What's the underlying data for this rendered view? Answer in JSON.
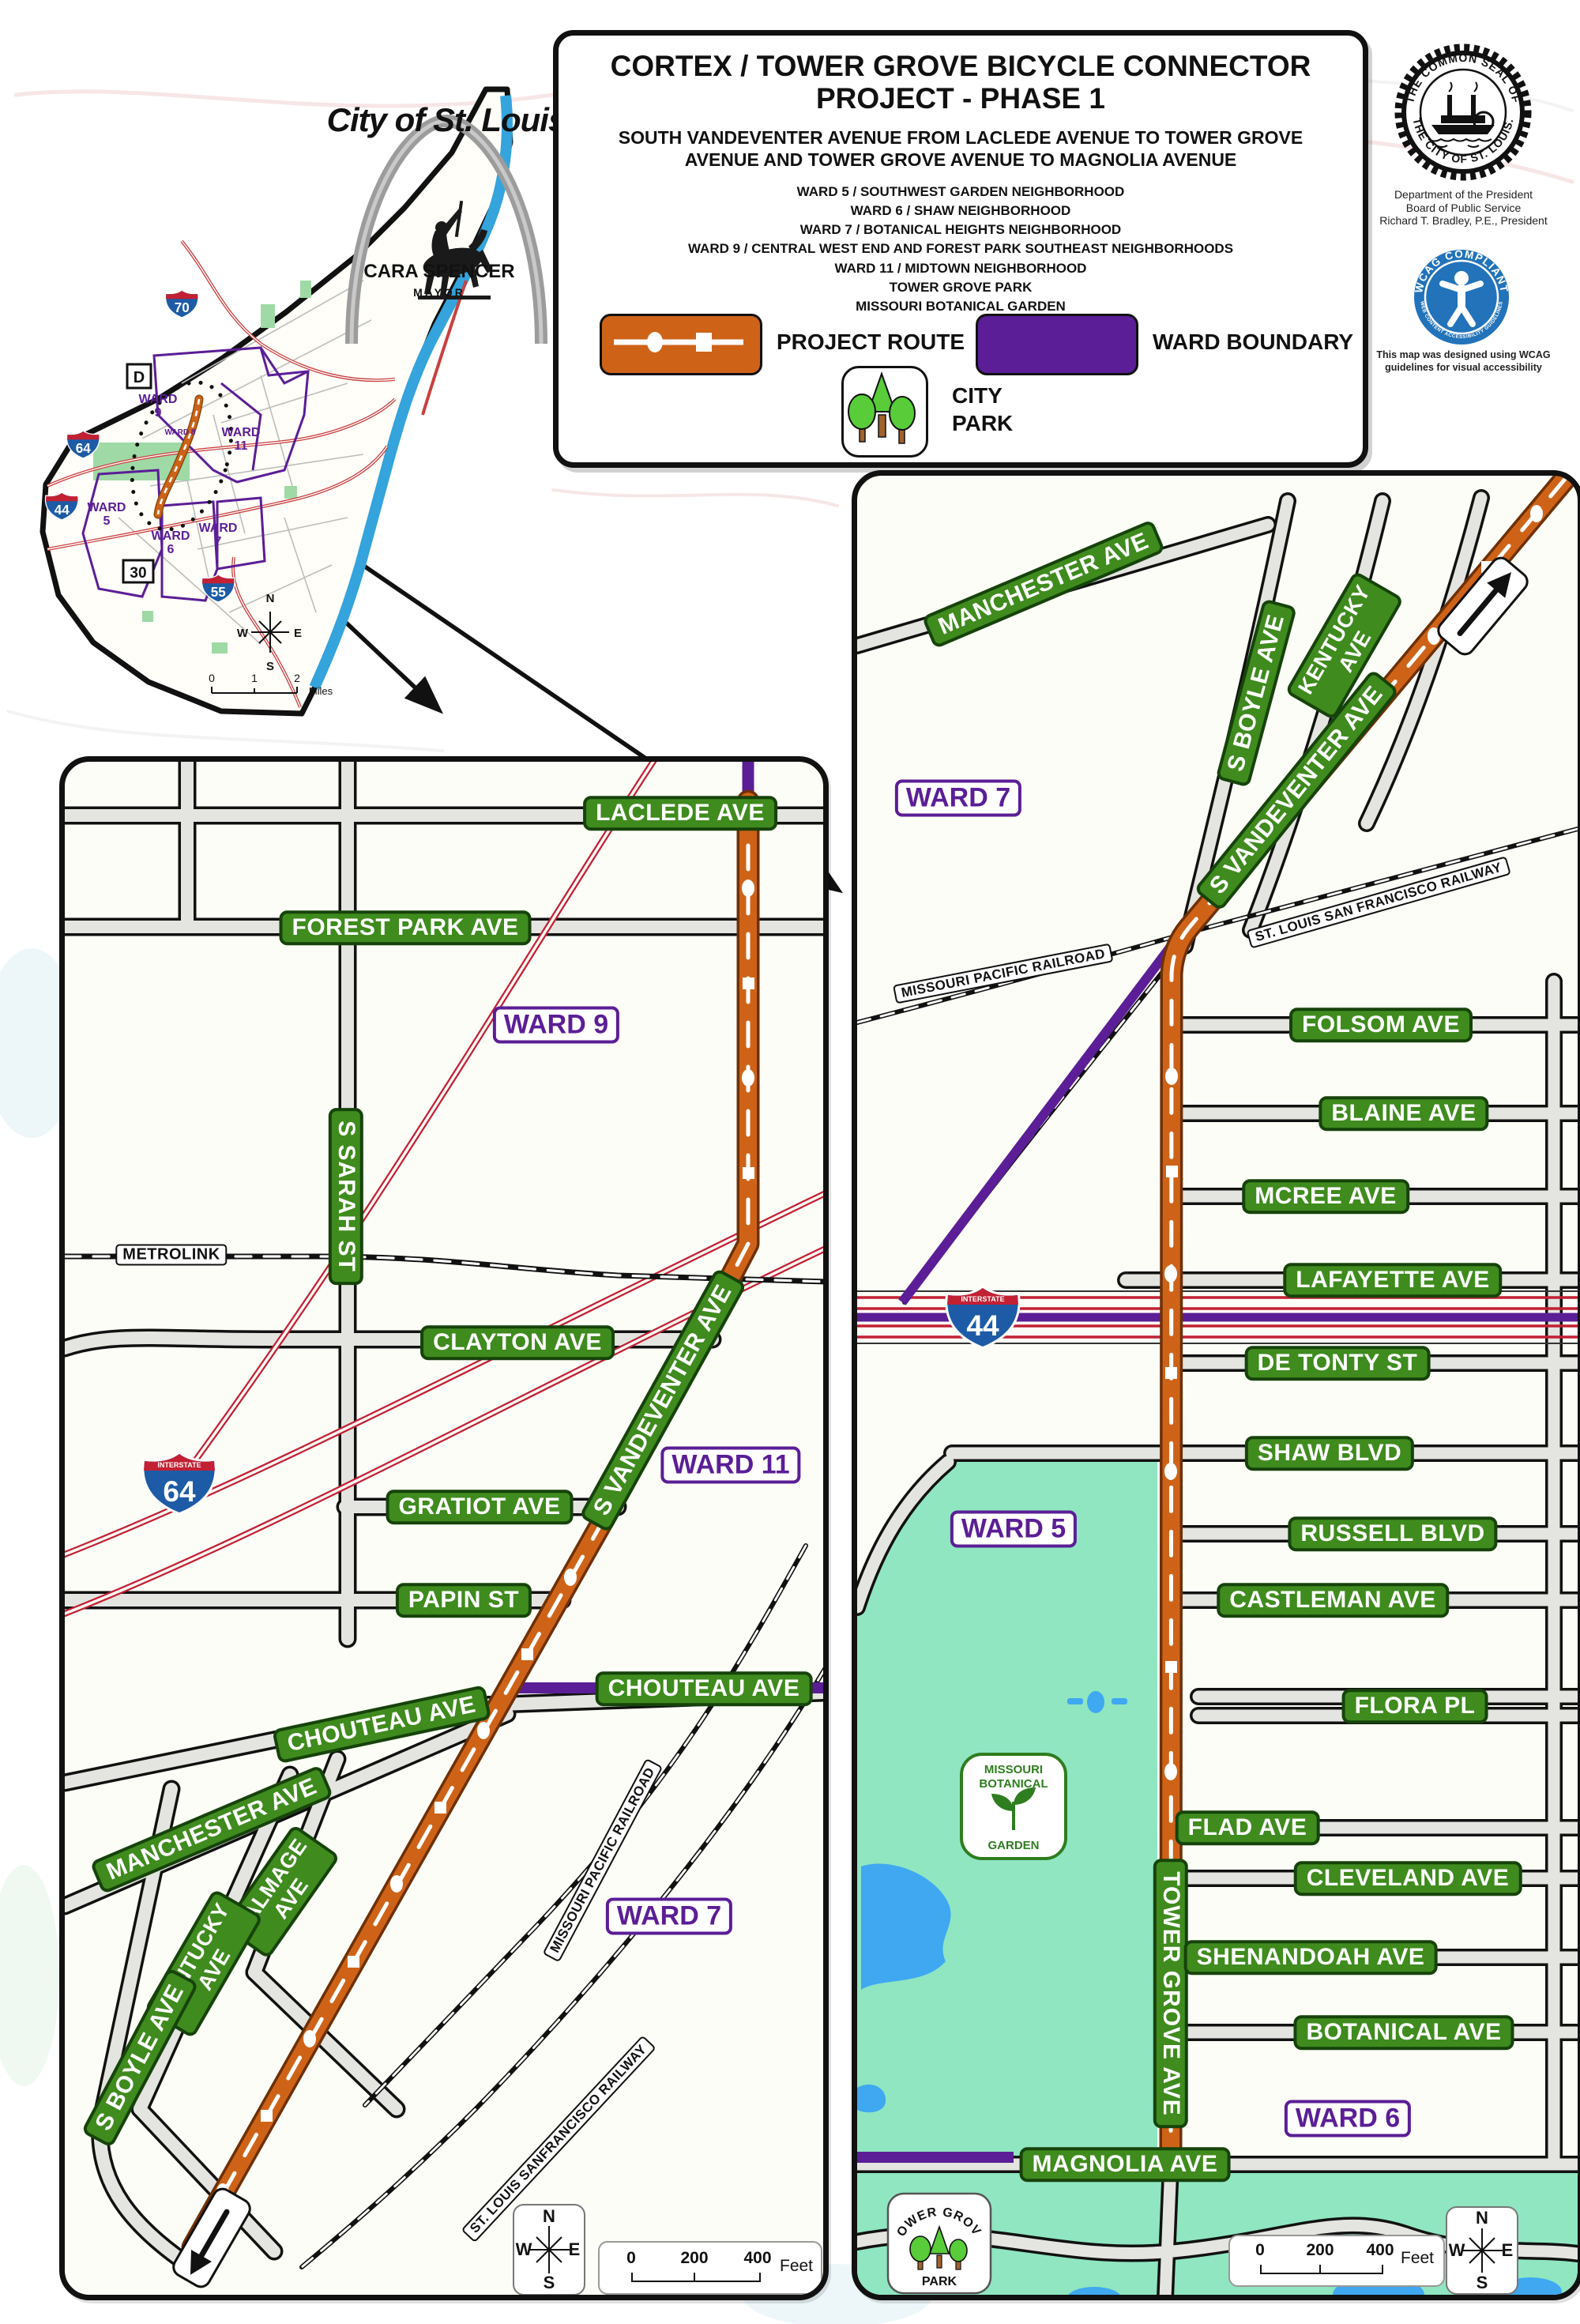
{
  "colors": {
    "project_route": "#CE6318",
    "ward_boundary": "#5B1E96",
    "city_park": "#8FE6C1",
    "street_sign_green": "#3F8B1E",
    "interstate_red": "#C22033",
    "interstate_blue": "#1D5BA6",
    "wcag_blue": "#2273BA",
    "river_blue": "#35A3DC"
  },
  "title_block": {
    "title": "CORTEX / TOWER GROVE BICYCLE CONNECTOR PROJECT - PHASE 1",
    "subtitle": "SOUTH VANDEVENTER AVENUE FROM LACLEDE AVENUE TO TOWER GROVE AVENUE AND TOWER GROVE AVENUE TO MAGNOLIA AVENUE",
    "areas": [
      "WARD 5 / SOUTHWEST GARDEN NEIGHBORHOOD",
      "WARD 6 / SHAW NEIGHBORHOOD",
      "WARD 7 / BOTANICAL HEIGHTS NEIGHBORHOOD",
      "WARD 9 / CENTRAL WEST END AND FOREST PARK SOUTHEAST NEIGHBORHOODS",
      "WARD 11 / MIDTOWN NEIGHBORHOOD",
      "TOWER GROVE PARK",
      "MISSOURI BOTANICAL GARDEN"
    ],
    "legend": {
      "route": "PROJECT ROUTE",
      "ward": "WARD BOUNDARY",
      "park": "CITY PARK"
    }
  },
  "branding": {
    "logo_title": "City of St. Louis",
    "mayor_name": "CARA SPENCER",
    "mayor_title": "MAYOR",
    "seal": {
      "arc_top": "THE COMMON SEAL OF",
      "arc_bottom": "THE CITY OF ST. LOUIS.",
      "caption": [
        "Department of the President",
        "Board of Public Service",
        "Richard T. Bradley, P.E., President"
      ]
    },
    "wcag": {
      "arc_top": "WCAG COMPLIANT",
      "arc_bottom": "WEB CONTENT ACCESSIBILITY GUIDELINES",
      "caption": [
        "This map was designed using WCAG",
        "guidelines for visual accessibility"
      ]
    }
  },
  "compass": {
    "n": "N",
    "e": "E",
    "s": "S",
    "w": "W"
  },
  "scale_detail": {
    "t0": "0",
    "t1": "200",
    "t2": "400",
    "unit": "Feet"
  },
  "scale_inset": {
    "t0": "0",
    "t1": "1",
    "t2": "2",
    "unit": "Miles"
  },
  "shield_word": "INTERSTATE",
  "inset_map": {
    "wards": [
      "WARD\n9",
      "WARD 8",
      "WARD\n11",
      "WARD\n5",
      "WARD\n6",
      "WARD\n7"
    ],
    "shields": {
      "i70": "70",
      "i64": "64",
      "i44": "44",
      "i55": "55",
      "d": "D",
      "r30": "30"
    }
  },
  "left_map": {
    "streets": [
      "LACLEDE AVE",
      "FOREST PARK AVE",
      "S SARAH ST",
      "CLAYTON AVE",
      "S VANDEVENTER AVE",
      "GRATIOT AVE",
      "PAPIN ST",
      "CHOUTEAU AVE",
      "CHOUTEAU AVE",
      "MANCHESTER AVE",
      "TALMAGE\nAVE",
      "KENTUCKY\nAVE",
      "S BOYLE AVE"
    ],
    "wards": [
      "WARD 9",
      "WARD 11",
      "WARD 7"
    ],
    "railroads": [
      "METROLINK",
      "MISSOURI PACIFIC RAILROAD",
      "ST. LOUIS SANFRANCISCO RAILWAY"
    ],
    "shield_i64": "64"
  },
  "right_map": {
    "streets": [
      "MANCHESTER AVE",
      "KENTUCKY\nAVE",
      "S BOYLE AVE",
      "S VANDEVENTER AVE",
      "FOLSOM AVE",
      "BLAINE AVE",
      "MCREE AVE",
      "LAFAYETTE AVE",
      "DE TONTY ST",
      "SHAW BLVD",
      "RUSSELL BLVD",
      "CASTLEMAN AVE",
      "FLORA PL",
      "TOWER GROVE AVE",
      "FLAD AVE",
      "CLEVELAND AVE",
      "SHENANDOAH AVE",
      "BOTANICAL AVE",
      "MAGNOLIA AVE"
    ],
    "wards": [
      "WARD 7",
      "WARD 5",
      "WARD 6"
    ],
    "railroads": [
      "MISSOURI PACIFIC RAILROAD",
      "ST. LOUIS SAN FRANCISCO RAILWAY"
    ],
    "shield_i44": "44",
    "garden_icon": [
      "MISSOURI",
      "BOTANICAL",
      "GARDEN"
    ],
    "park_icon": [
      "TOWER GROVE",
      "PARK"
    ]
  }
}
